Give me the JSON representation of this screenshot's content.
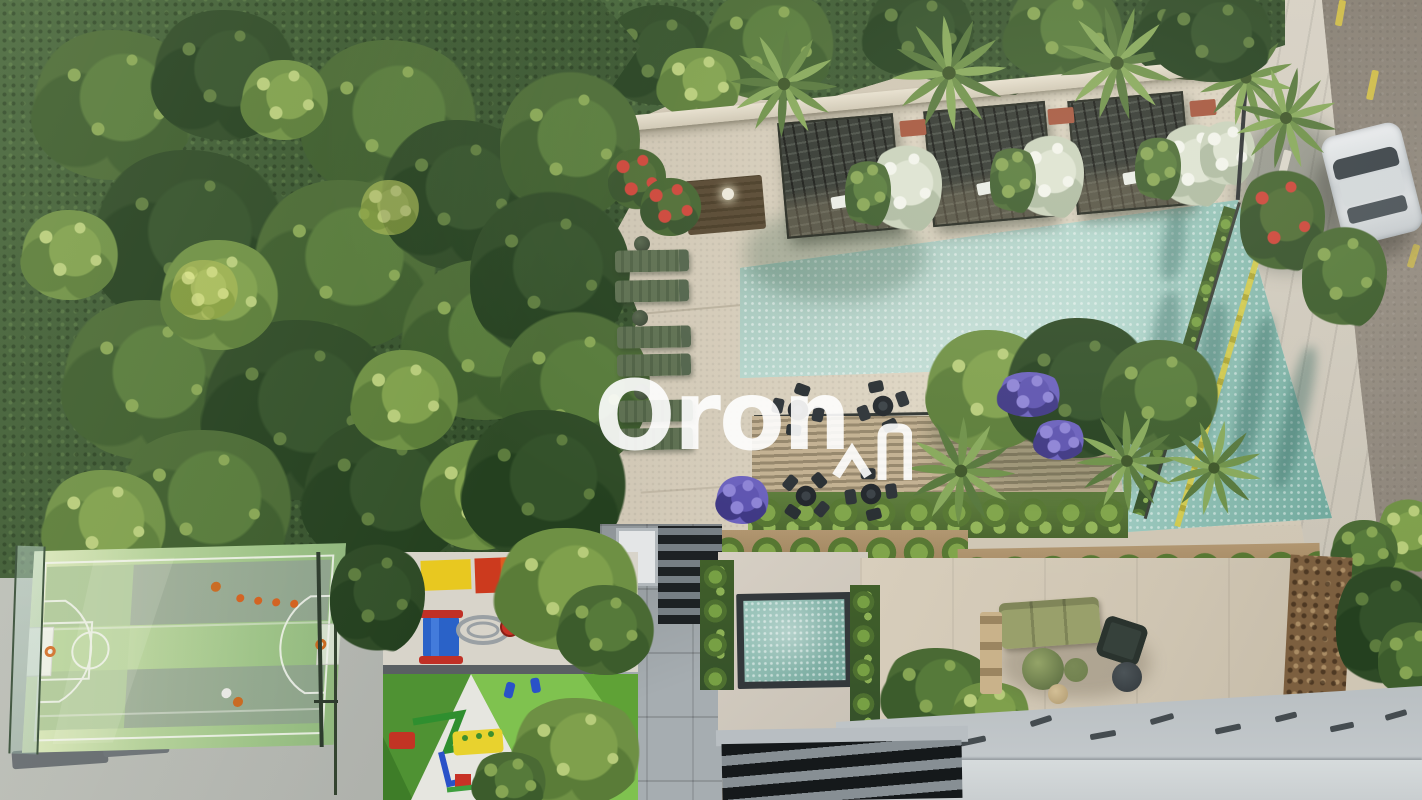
{
  "watermark": {
    "text": "Oron",
    "logo_icon": "peak-arch-logo-icon",
    "color": "#ffffff"
  },
  "scene": {
    "kind": "aerial 3D architectural rendering of a residential amenity deck",
    "elements": [
      "dense forest on left",
      "rooftop pool deck with long aqua lap pool",
      "three dark trellis cabanas with white flower planters",
      "six green sun loungers",
      "palm trees",
      "poolside dining sets",
      "timber slat deck",
      "hedge-topped pergolas",
      "lower courtyard with plunge pool and staircases",
      "lounge terrace with olive sofa and poufs",
      "basketball court with hoops, cones and balls",
      "playground with colorful equipment",
      "street with silver car and yellow lane dashes",
      "lower building rooftop with vents",
      "stone feature wall"
    ],
    "palette": {
      "foliage_dark": "#2e4a26",
      "foliage_mid": "#4a6a34",
      "foliage_light": "#6e9044",
      "deck_beige": "#d8d0bf",
      "pool_aqua": "#b7dbd3",
      "pool_deep": "#6ea79b",
      "road_asphalt": "#8e867b",
      "road_marking_yellow": "#d6c244",
      "court_green": "#b3d098",
      "playground_green": "#6fae43",
      "pergola_dark": "#2d3230",
      "roof_gray": "#c2c8ca",
      "stone_wall_brown": "#7c5f3f"
    }
  }
}
